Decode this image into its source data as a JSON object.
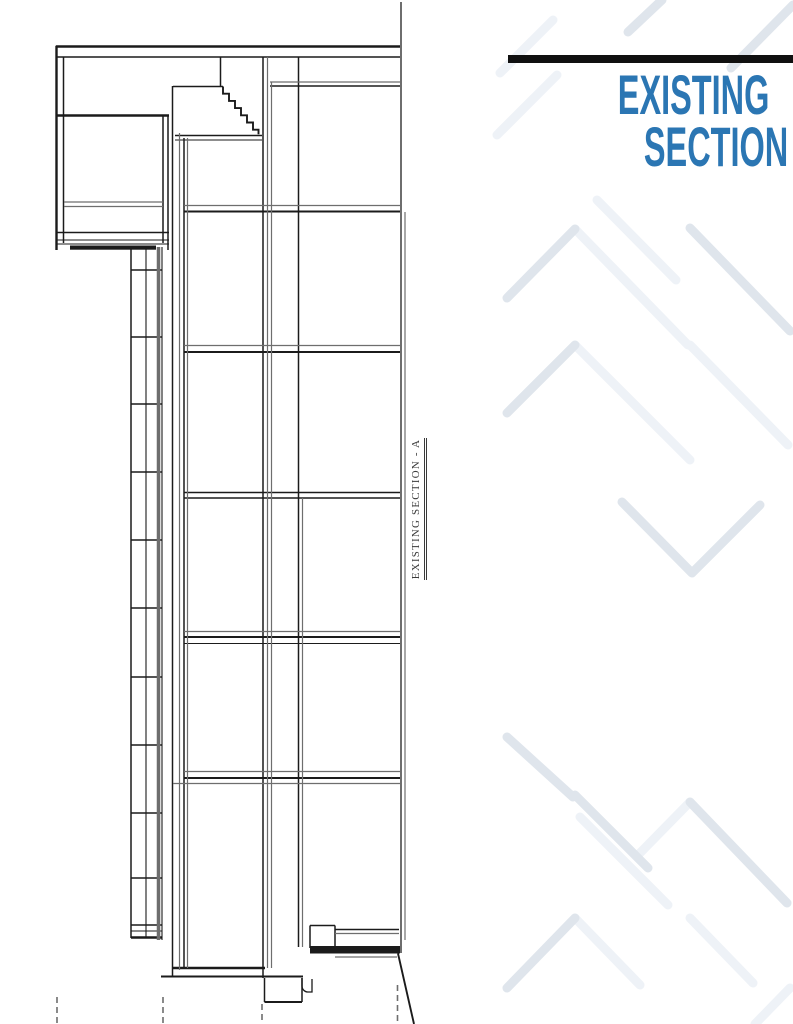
{
  "colors": {
    "paper": "#ffffff",
    "ink": "#1b1b1b",
    "mid": "#6e6e6e",
    "accent": "#2b76b3",
    "rule": "#101010",
    "chev": "#dfe5ec",
    "chevf": "#eef2f7",
    "label": "#3a3a3a"
  },
  "title_block": {
    "line1": "EXISTING",
    "line2": "SECTION -A"
  },
  "drawing": {
    "vertical_label": "EXISTING SECTION - A"
  }
}
